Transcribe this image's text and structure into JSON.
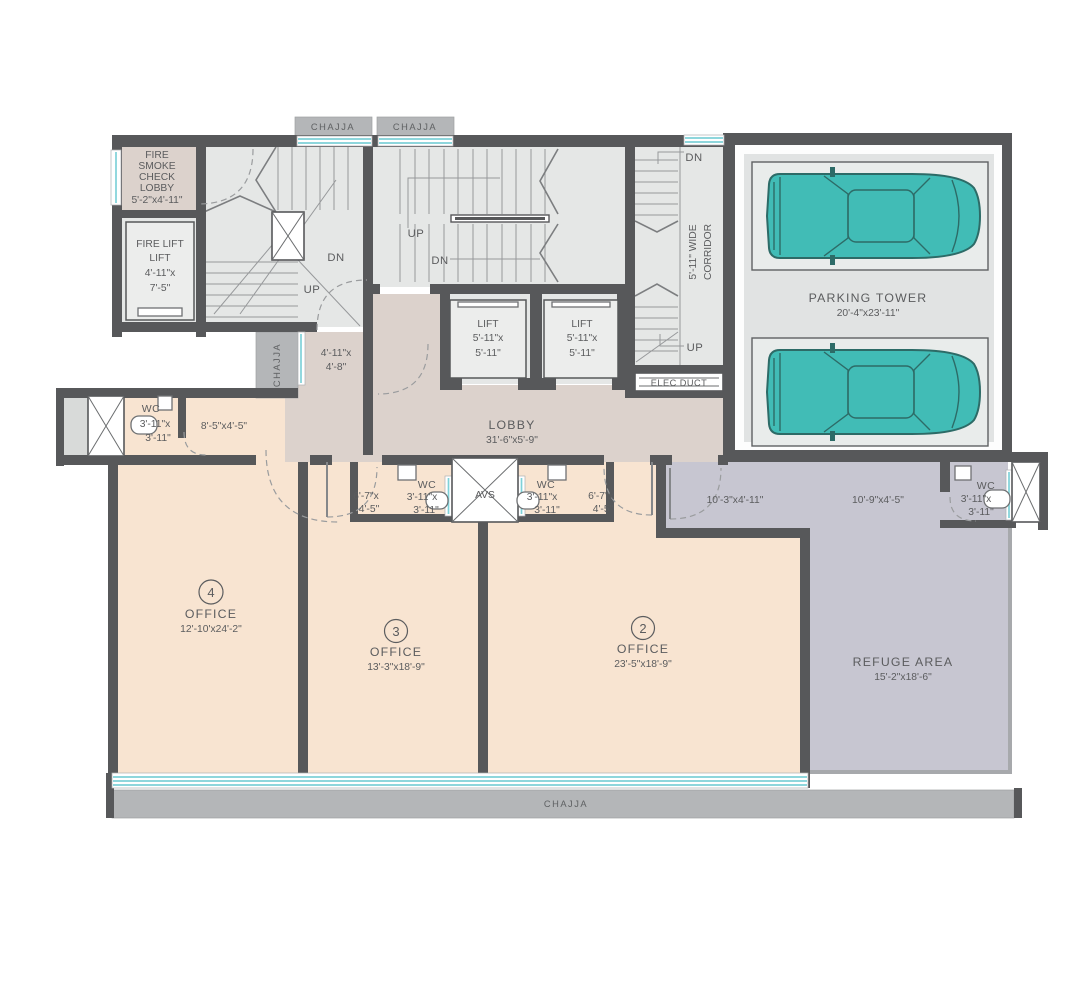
{
  "colors": {
    "wall": "#57585a",
    "office": "#f8e4d1",
    "lobby": "#dcd2cc",
    "stair": "#e5e7e6",
    "refuge": "#c7c6d1",
    "parking": "#e1e3e3",
    "chajja": "#b4b6b8",
    "window": "#7ed1d8",
    "car": "#41bcb6",
    "car_line": "#2d6b67",
    "text": "#5b5c5e",
    "tread": "#97999b"
  },
  "common": {
    "chajja": "CHAJJA",
    "up": "UP",
    "dn": "DN",
    "wc": "WC",
    "office": "OFFICE"
  },
  "fire_lobby": {
    "l1": "FIRE",
    "l2": "SMOKE",
    "l3": "CHECK",
    "l4": "LOBBY",
    "dim": "5'-2\"x4'-11\""
  },
  "fire_lift": {
    "l1": "FIRE LIFT",
    "l2": "LIFT",
    "d1": "4'-11\"x",
    "d2": "7'-5\""
  },
  "lift": {
    "name": "LIFT",
    "d1": "5'-11\"x",
    "d2": "5'-11\""
  },
  "corridor": {
    "l1": "5'-11\" WIDE",
    "l2": "CORRIDOR"
  },
  "elec_duct": "ELEC DUCT",
  "avs": "AVS",
  "parking": {
    "name": "PARKING TOWER",
    "dim": "20'-4\"x23'-11\""
  },
  "lobby": {
    "name": "LOBBY",
    "dim": "31'-6\"x5'-9\""
  },
  "lobby_passage": {
    "d1": "4'-11\"x",
    "d2": "4'-8\""
  },
  "passage_8_5": "8'-5\"x4'-5\"",
  "wc_dim": {
    "d1": "3'-11\"x",
    "d2": "3'-11\""
  },
  "passage_6_7": {
    "d1": "6'-7\"x",
    "d2": "4'-5\""
  },
  "refuge_passage_a": "10'-3\"x4'-11\"",
  "refuge_passage_b": "10'-9\"x4'-5\"",
  "office2": {
    "num": "2",
    "dim": "23'-5\"x18'-9\""
  },
  "office3": {
    "num": "3",
    "dim": "13'-3\"x18'-9\""
  },
  "office4": {
    "num": "4",
    "dim": "12'-10'x24'-2\""
  },
  "refuge": {
    "name": "REFUGE AREA",
    "dim": "15'-2\"x18'-6\""
  }
}
